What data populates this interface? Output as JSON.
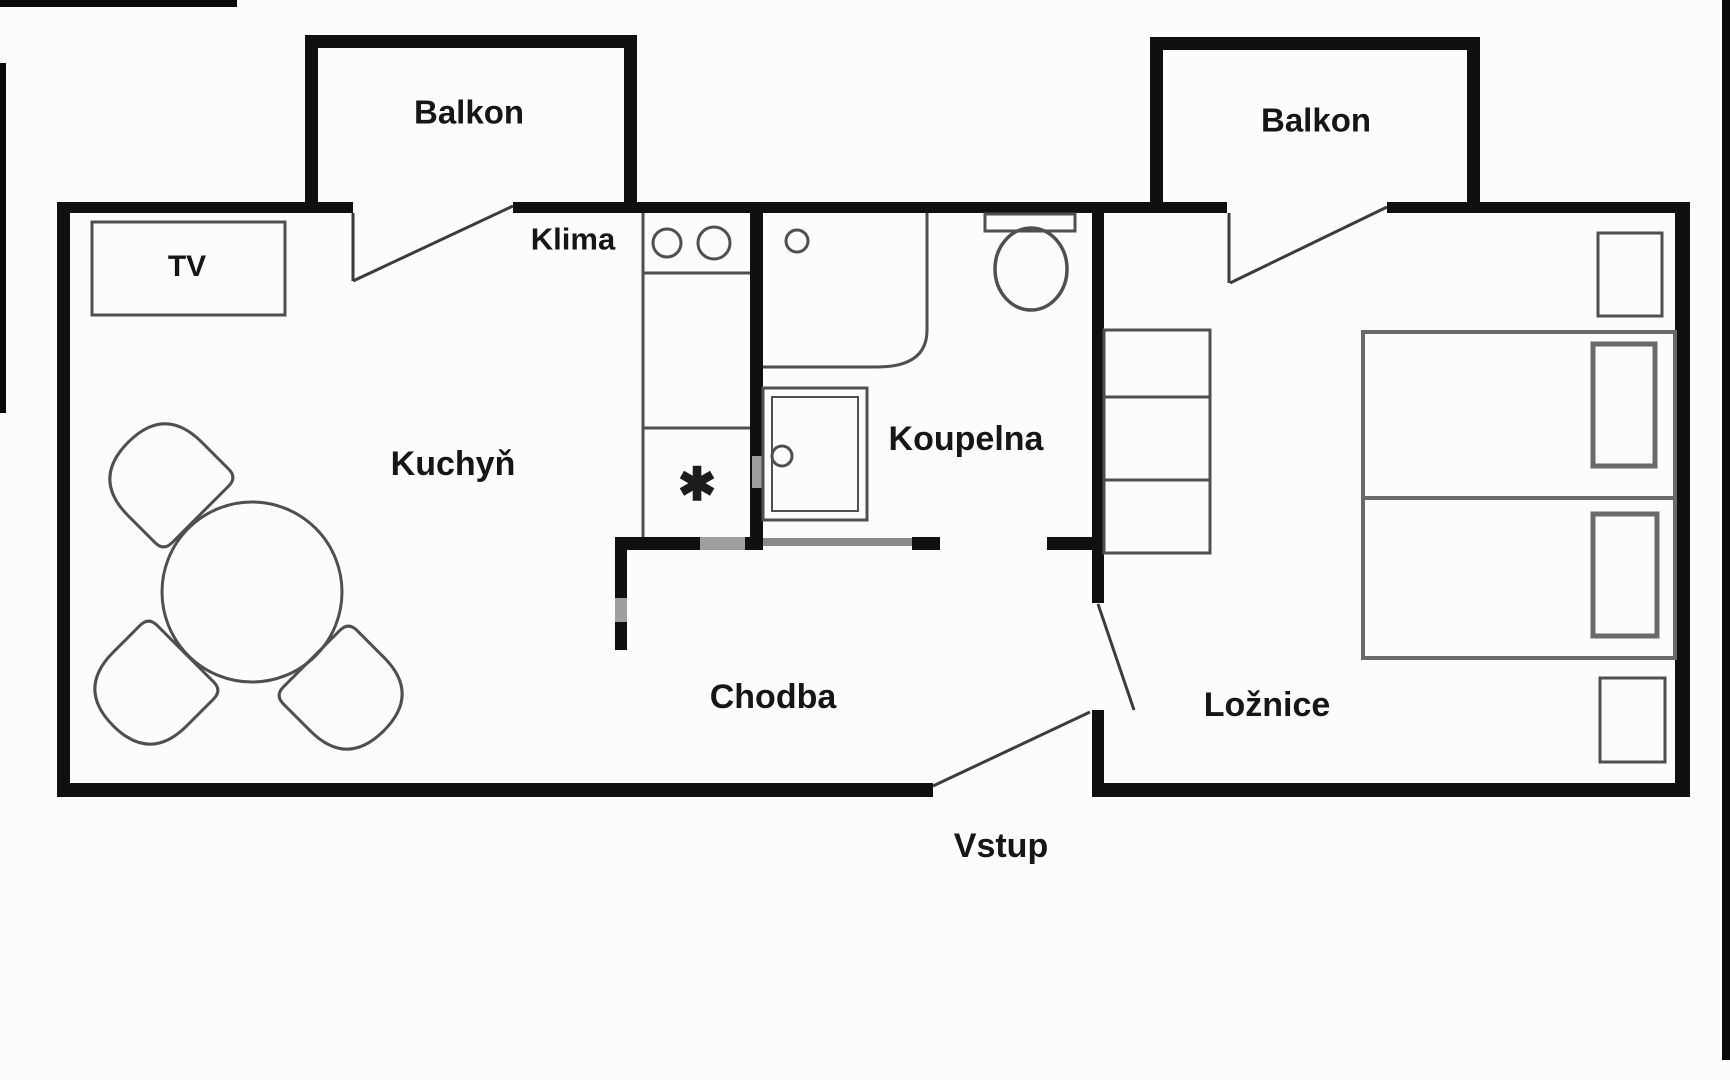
{
  "meta": {
    "type": "apartment-floor-plan",
    "language": "cs"
  },
  "colors": {
    "background": "#fcfcfc",
    "wall": "#101010",
    "thin_wall": "#8a8a8a",
    "furniture_line": "#4f4f4f",
    "door_line": "#3c3c3c",
    "label_text": "#161616"
  },
  "labels": {
    "balcony_left": "Balkon",
    "balcony_right": "Balkon",
    "tv": "TV",
    "klima": "Klima",
    "kitchen": "Kuchyň",
    "bathroom": "Koupelna",
    "hallway": "Chodba",
    "bedroom": "Ložnice",
    "entrance": "Vstup",
    "stove_symbol": "✱"
  },
  "rooms": [
    {
      "id": "kuchyn",
      "label": "Kuchyň",
      "features": [
        "TV",
        "dining-table",
        "three-chairs",
        "kitchen-counter",
        "stove-burners",
        "Klima"
      ]
    },
    {
      "id": "koupelna",
      "label": "Koupelna",
      "features": [
        "vanity-sink",
        "shower",
        "toilet"
      ]
    },
    {
      "id": "chodba",
      "label": "Chodba",
      "features": []
    },
    {
      "id": "loznice",
      "label": "Ložnice",
      "features": [
        "wardrobe-shelves",
        "bed-1",
        "bed-2",
        "nightstand-1",
        "nightstand-2"
      ]
    },
    {
      "id": "balkon-left",
      "label": "Balkon",
      "features": []
    },
    {
      "id": "balkon-right",
      "label": "Balkon",
      "features": []
    },
    {
      "id": "vstup",
      "label": "Vstup",
      "features": [
        "entry-door"
      ]
    }
  ]
}
